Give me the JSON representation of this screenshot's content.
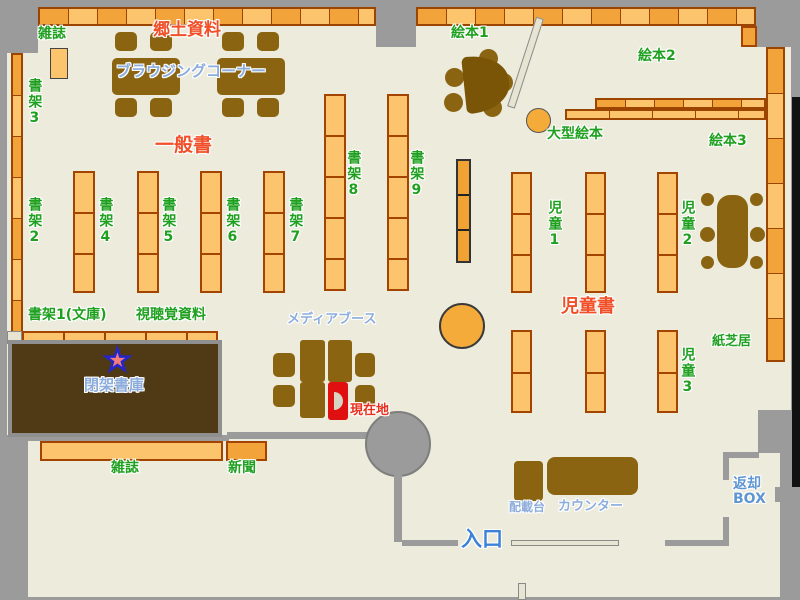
{
  "map_title": "library floor map",
  "labels": {
    "magazines_top": "雑誌",
    "local_materials": "郷土資料",
    "browsing_corner": "ブラウジングコーナー",
    "general_books": "一般書",
    "shelf2": "書架2",
    "shelf3": "書架3",
    "shelf4": "書架4",
    "shelf5": "書架5",
    "shelf6": "書架6",
    "shelf7": "書架7",
    "shelf8": "書架8",
    "shelf9": "書架9",
    "shelf1_bunko": "書架1(文庫)",
    "audio_visual": "視聴覚資料",
    "picture_books1": "絵本1",
    "picture_books2": "絵本2",
    "picture_books3": "絵本3",
    "large_picture_books": "大型絵本",
    "children1": "児童1",
    "children2": "児童2",
    "children3": "児童3",
    "children_books": "児童書",
    "kamishibai": "紙芝居",
    "media_booth": "メディアブース",
    "current_location": "現在地",
    "closed_stacks": "閉架書庫",
    "magazines_bottom": "雑誌",
    "newspapers": "新聞",
    "sorting_table": "配載台",
    "counter": "カウンター",
    "entrance": "入口",
    "return_box": "返却\nBOX"
  },
  "icons": {
    "current_location_star": "★"
  },
  "palette": {
    "floor": "#ECEBDC",
    "wall_gray": "#9B9B9B",
    "shelf_light_orange": "#FBC46D",
    "shelf_dark_orange": "#F2A43A",
    "shelf_border": "#9C4500",
    "furniture_brown": "#8A6410",
    "closed_stacks_brown": "#503A16",
    "label_green": "#1FA01F",
    "label_red": "#F04F28",
    "label_light_blue": "#8CACDC",
    "entrance_blue": "#3B82D8",
    "current_location_red": "#E8301E",
    "marker_box_red": "#E01010",
    "star_pink": "#F47C7C",
    "star_outline_blue": "#2525CC"
  }
}
